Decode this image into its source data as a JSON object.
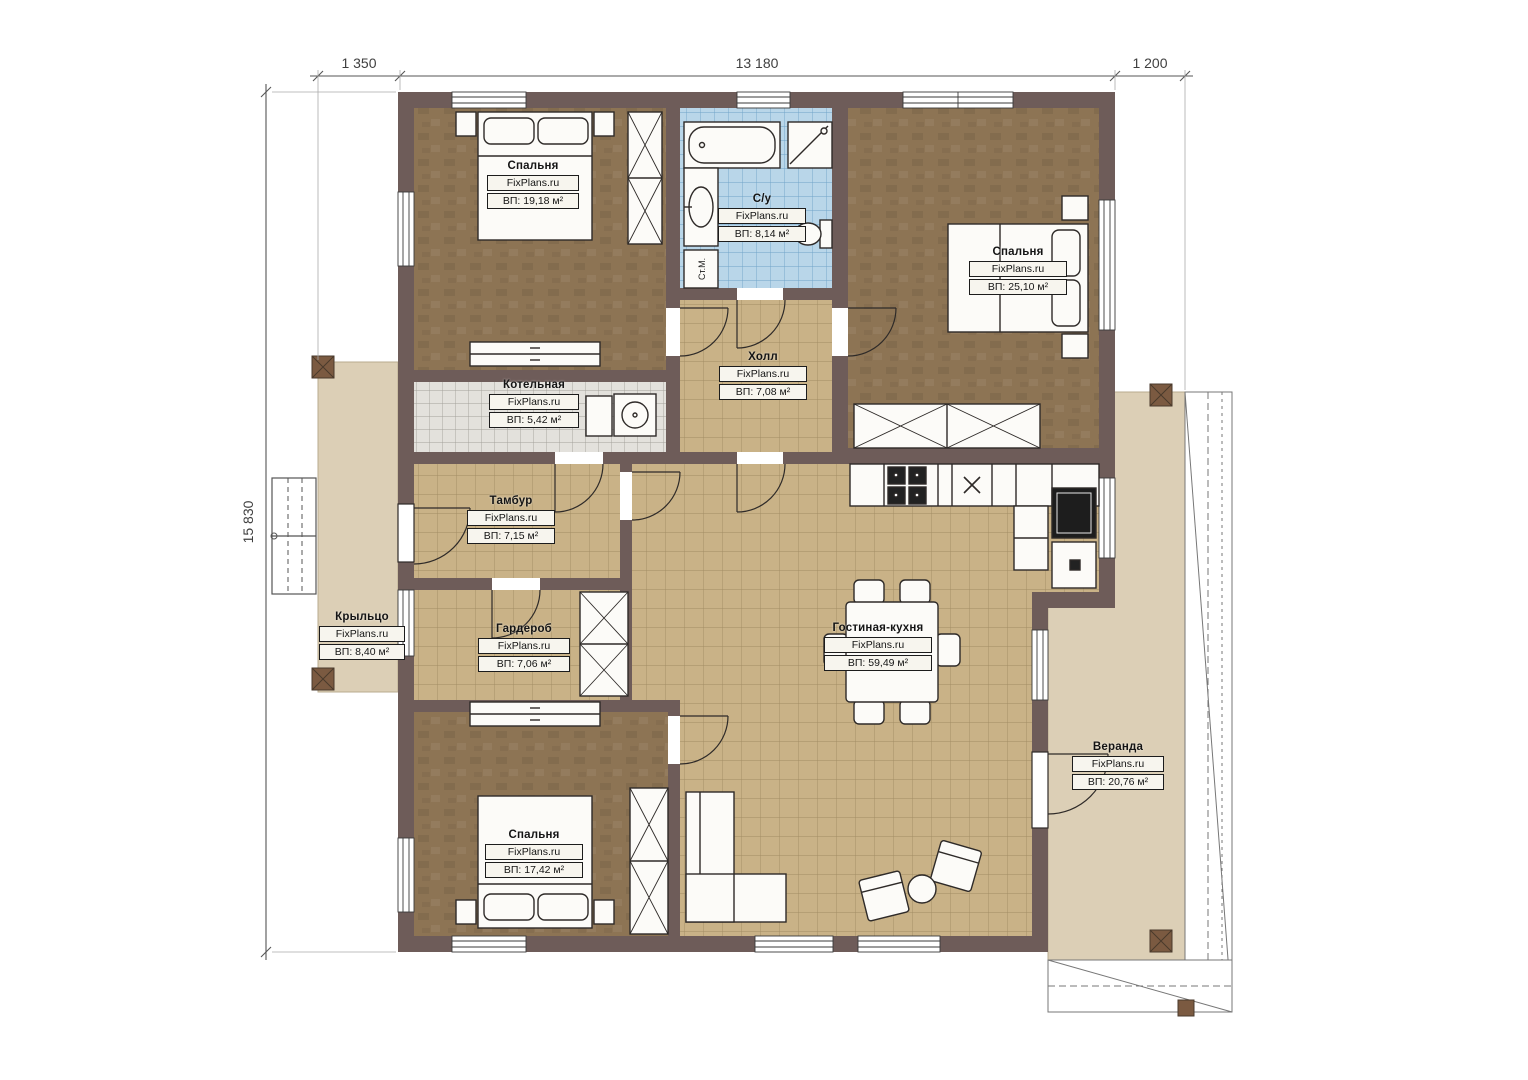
{
  "dimensions": {
    "top_left": "1 350",
    "top_span": "13 180",
    "top_right": "1 200",
    "side": "15 830"
  },
  "rooms": [
    {
      "key": "bedroom-1",
      "name": "Спальня",
      "brand": "FixPlans.ru",
      "area": "ВП: 19,18 м²"
    },
    {
      "key": "bathroom",
      "name": "С/у",
      "brand": "FixPlans.ru",
      "area": "ВП: 8,14 м²"
    },
    {
      "key": "bedroom-2",
      "name": "Спальня",
      "brand": "FixPlans.ru",
      "area": "ВП: 25,10 м²"
    },
    {
      "key": "boiler-room",
      "name": "Котельная",
      "brand": "FixPlans.ru",
      "area": "ВП: 5,42 м²"
    },
    {
      "key": "hall",
      "name": "Холл",
      "brand": "FixPlans.ru",
      "area": "ВП: 7,08 м²"
    },
    {
      "key": "vestibule",
      "name": "Тамбур",
      "brand": "FixPlans.ru",
      "area": "ВП: 7,15 м²"
    },
    {
      "key": "wardrobe",
      "name": "Гардероб",
      "brand": "FixPlans.ru",
      "area": "ВП: 7,06 м²"
    },
    {
      "key": "bedroom-3",
      "name": "Спальня",
      "brand": "FixPlans.ru",
      "area": "ВП: 17,42 м²"
    },
    {
      "key": "living-kitchen",
      "name": "Гостиная-кухня",
      "brand": "FixPlans.ru",
      "area": "ВП: 59,49 м²"
    },
    {
      "key": "veranda",
      "name": "Веранда",
      "brand": "FixPlans.ru",
      "area": "ВП: 20,76 м²"
    },
    {
      "key": "porch",
      "name": "Крыльцо",
      "brand": "FixPlans.ru",
      "area": "ВП: 8,40 м²"
    }
  ],
  "annotations": {
    "washing_machine": "Ст.М."
  },
  "colors": {
    "wall": "#6e5c59",
    "wall_edge": "#4a3f3b",
    "wood_floor": "#8d7454",
    "tile_floor": "#c9b287",
    "tile_line": "#a18c63",
    "bath_floor": "#b9d6e9",
    "bath_line": "#6fa3c8",
    "boiler_floor": "#e3e1dc",
    "boiler_line": "#a3a19a",
    "deck": "#dccfb6",
    "post": "#7b5a41",
    "furniture": "#fcfbf8",
    "line": "#2e2a28"
  }
}
